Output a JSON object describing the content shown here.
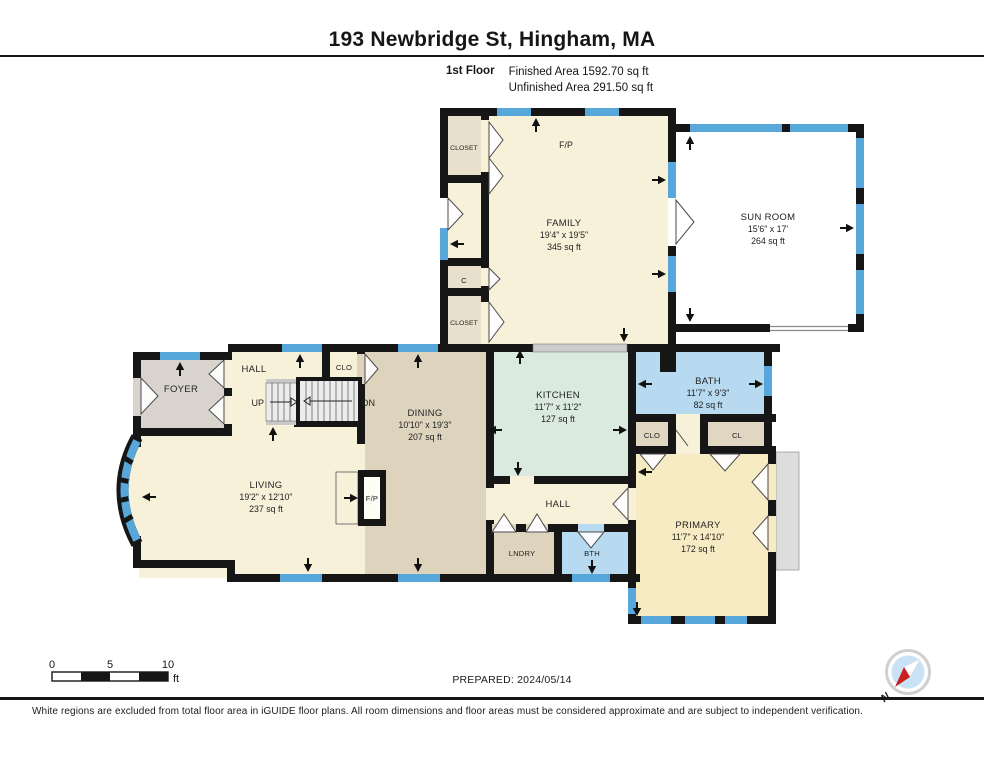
{
  "header": {
    "title": "193 Newbridge St, Hingham, MA",
    "floor_label": "1st Floor",
    "finished_area": "Finished Area 1592.70 sq ft",
    "unfinished_area": "Unfinished Area 291.50 sq ft"
  },
  "rooms": {
    "family": {
      "name": "FAMILY",
      "dims": "19'4\" x 19'5\"",
      "area": "345 sq ft"
    },
    "sunroom": {
      "name": "SUN ROOM",
      "dims": "15'6\" x 17'",
      "area": "264 sq ft"
    },
    "dining": {
      "name": "DINING",
      "dims": "10'10\" x 19'3\"",
      "area": "207 sq ft"
    },
    "kitchen": {
      "name": "KITCHEN",
      "dims": "11'7\" x 11'2\"",
      "area": "127 sq ft"
    },
    "bath": {
      "name": "BATH",
      "dims": "11'7\" x 9'3\"",
      "area": "82 sq ft"
    },
    "living": {
      "name": "LIVING",
      "dims": "19'2\" x 12'10\"",
      "area": "237 sq ft"
    },
    "primary": {
      "name": "PRIMARY",
      "dims": "11'7\" x 14'10\"",
      "area": "172 sq ft"
    },
    "foyer": {
      "name": "FOYER"
    },
    "hall_upper": {
      "name": "HALL"
    },
    "hall_lower": {
      "name": "HALL"
    },
    "laundry": {
      "name": "LNDRY"
    },
    "bth": {
      "name": "BTH"
    },
    "closet_top": {
      "name": "CLOSET"
    },
    "closet_c": {
      "name": "C"
    },
    "closet_bottom": {
      "name": "CLOSET"
    },
    "clo_hall": {
      "name": "CLO"
    },
    "clo_bath": {
      "name": "CLO"
    },
    "cl": {
      "name": "CL"
    },
    "fireplace_family": {
      "name": "F/P"
    },
    "fireplace_living": {
      "name": "F/P"
    },
    "stairs_up": {
      "name": "UP"
    },
    "stairs_down": {
      "name": "DN"
    }
  },
  "scale_bar": {
    "tick_0": "0",
    "tick_5": "5",
    "tick_10": "10",
    "unit": "ft"
  },
  "footer": {
    "prepared": "PREPARED: 2024/05/14",
    "disclaimer": "White regions are excluded from total floor area in iGUIDE floor plans. All room dimensions and floor areas must be considered approximate and are subject to independent verification."
  },
  "compass": {
    "north_label": "N"
  },
  "colors": {
    "wall": "#161616",
    "window_blue": "#58a7db",
    "finished_cream": "#f8f1da",
    "primary_cream": "#f7ebc4",
    "dining_tan": "#ded4be",
    "kitchen_mint": "#dbeadf",
    "bath_blue": "#b7daf1",
    "foyer_gray": "#d8d4cd",
    "closet_tan": "#e8e0cd"
  }
}
